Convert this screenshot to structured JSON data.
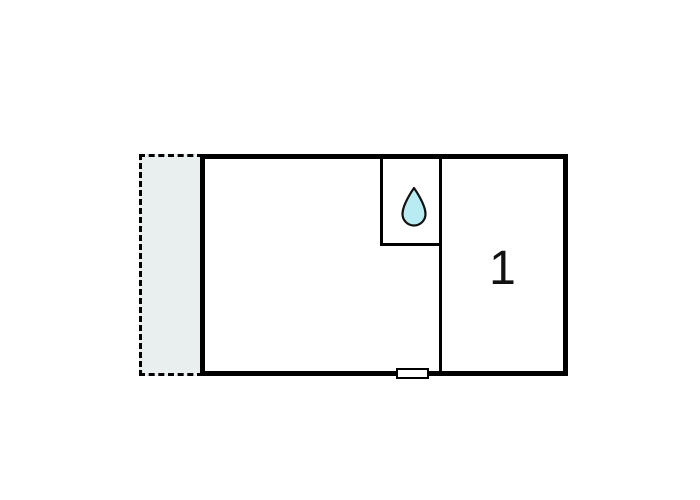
{
  "floorplan": {
    "colors": {
      "background": "#ffffff",
      "wall": "#000000",
      "terrace_fill": "#e8efee",
      "drop_fill": "#b9ecf2",
      "drop_stroke": "#111111",
      "window_fill": "#ffffff"
    },
    "terrace": {
      "border_style": "dashed"
    },
    "bathroom": {
      "icon": "water-drop-icon"
    },
    "room1": {
      "label": "1"
    }
  }
}
